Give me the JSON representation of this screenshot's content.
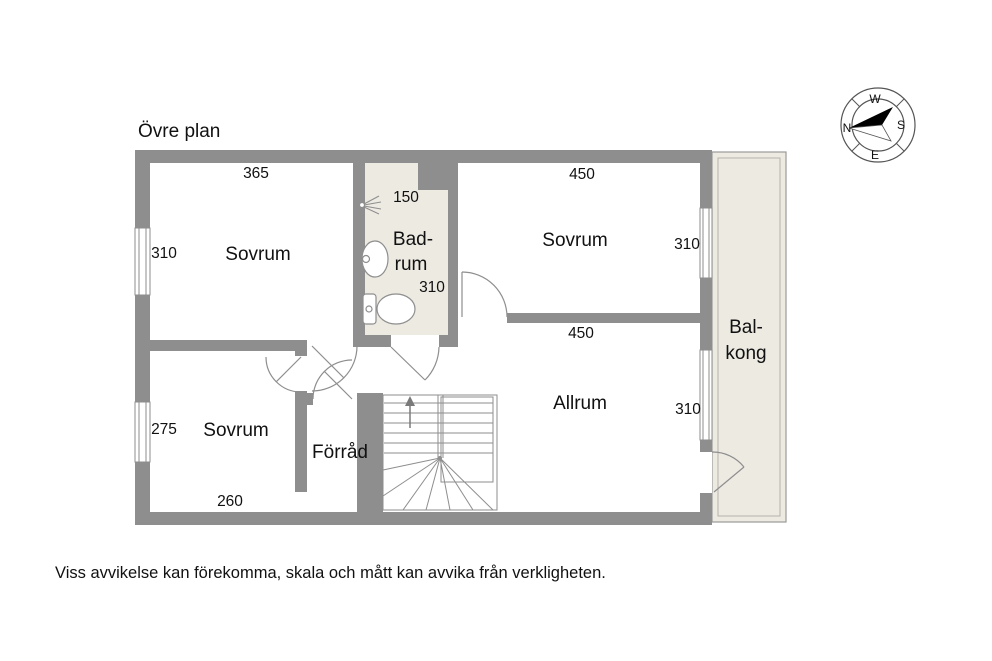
{
  "title": "Övre plan",
  "footer": "Viss avvikelse kan förekomma, skala och mått kan avvika från verkligheten.",
  "compass": {
    "north": "N",
    "south": "S",
    "east": "E",
    "west": "W"
  },
  "rooms": {
    "sovrum_top_left": "Sovrum",
    "badrum_line1": "Bad-",
    "badrum_line2": "rum",
    "sovrum_top_right": "Sovrum",
    "allrum": "Allrum",
    "sovrum_bottom_left": "Sovrum",
    "forrad": "Förråd",
    "balkong_line1": "Bal-",
    "balkong_line2": "kong"
  },
  "dimensions": {
    "sovrum_tl_width": "365",
    "sovrum_tl_depth": "310",
    "badrum_width": "150",
    "badrum_depth": "310",
    "sovrum_tr_width": "450",
    "sovrum_tr_depth": "310",
    "allrum_width": "450",
    "allrum_depth": "310",
    "sovrum_bl_depth": "275",
    "sovrum_bl_width": "260"
  },
  "colors": {
    "wall": "#8e8e8e",
    "tiled_floor": "#edeae2",
    "line": "#8e8e8e",
    "text": "#111111",
    "background": "#ffffff"
  }
}
